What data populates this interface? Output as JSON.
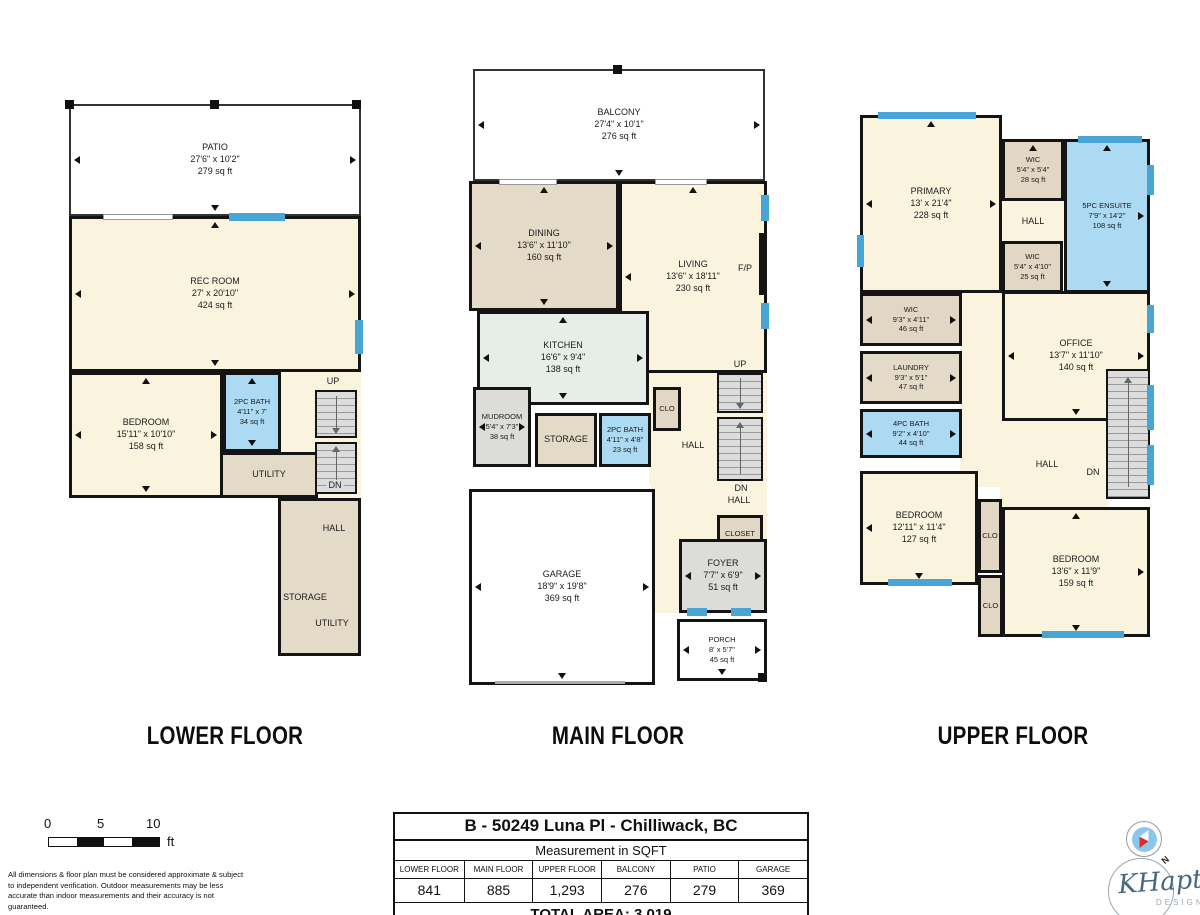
{
  "colors": {
    "wall": "#141414",
    "window_blue": "#49A5D6",
    "room_cream": "#FAF3DE",
    "room_tan": "#E4DAC8",
    "room_bath_blue": "#ABDAF2",
    "room_kitchen": "#E6EEE7",
    "room_gray": "#DCDDD9",
    "stairs_gray": "#DCDCDC",
    "compass_blue": "#8CC6EA",
    "compass_red": "#D93025",
    "logo_blue": "#47687F"
  },
  "floors": [
    {
      "label": "LOWER FLOOR",
      "rooms": [
        {
          "name": "PATIO",
          "dims": "27'6\" x 10'2\"",
          "sqft": "279 sq ft"
        },
        {
          "name": "REC ROOM",
          "dims": "27' x 20'10\"",
          "sqft": "424 sq ft"
        },
        {
          "name": "BEDROOM",
          "dims": "15'11\" x 10'10\"",
          "sqft": "158 sq ft"
        },
        {
          "name": "2PC BATH",
          "dims": "4'11\" x 7'",
          "sqft": "34 sq ft"
        },
        {
          "name": "UTILITY"
        },
        {
          "name": "UP"
        },
        {
          "name": "DN"
        },
        {
          "name": "HALL"
        },
        {
          "name": "STORAGE"
        },
        {
          "name": "UTILITY"
        }
      ]
    },
    {
      "label": "MAIN FLOOR",
      "rooms": [
        {
          "name": "BALCONY",
          "dims": "27'4\" x 10'1\"",
          "sqft": "276 sq ft"
        },
        {
          "name": "DINING",
          "dims": "13'6\" x 11'10\"",
          "sqft": "160 sq ft"
        },
        {
          "name": "LIVING",
          "dims": "13'6\" x 18'11\"",
          "sqft": "230 sq ft"
        },
        {
          "name": "F/P"
        },
        {
          "name": "KITCHEN",
          "dims": "16'6\" x 9'4\"",
          "sqft": "138 sq ft"
        },
        {
          "name": "MUDROOM",
          "dims": "5'4\" x 7'3\"",
          "sqft": "38 sq ft"
        },
        {
          "name": "STORAGE"
        },
        {
          "name": "2PC BATH",
          "dims": "4'11\" x 4'8\"",
          "sqft": "23 sq ft"
        },
        {
          "name": "CLO"
        },
        {
          "name": "HALL"
        },
        {
          "name": "UP"
        },
        {
          "name": "DN"
        },
        {
          "name": "HALL"
        },
        {
          "name": "CLOSET"
        },
        {
          "name": "GARAGE",
          "dims": "18'9\" x 19'8\"",
          "sqft": "369 sq ft"
        },
        {
          "name": "FOYER",
          "dims": "7'7\" x 6'9\"",
          "sqft": "51 sq ft"
        },
        {
          "name": "PORCH",
          "dims": "8' x 5'7\"",
          "sqft": "45 sq ft"
        }
      ]
    },
    {
      "label": "UPPER FLOOR",
      "rooms": [
        {
          "name": "PRIMARY",
          "dims": "13' x 21'4\"",
          "sqft": "228 sq ft"
        },
        {
          "name": "WIC",
          "dims": "5'4\" x 5'4\"",
          "sqft": "28 sq ft"
        },
        {
          "name": "5PC ENSUITE",
          "dims": "7'9\" x 14'2\"",
          "sqft": "108 sq ft"
        },
        {
          "name": "HALL"
        },
        {
          "name": "WIC",
          "dims": "5'4\" x 4'10\"",
          "sqft": "25 sq ft"
        },
        {
          "name": "WIC",
          "dims": "9'3\" x 4'11\"",
          "sqft": "46 sq ft"
        },
        {
          "name": "LAUNDRY",
          "dims": "9'3\" x 5'1\"",
          "sqft": "47 sq ft"
        },
        {
          "name": "4PC BATH",
          "dims": "9'2\" x 4'10\"",
          "sqft": "44 sq ft"
        },
        {
          "name": "OFFICE",
          "dims": "13'7\" x 11'10\"",
          "sqft": "140 sq ft"
        },
        {
          "name": "HALL"
        },
        {
          "name": "DN"
        },
        {
          "name": "BEDROOM",
          "dims": "12'11\" x 11'4\"",
          "sqft": "127 sq ft"
        },
        {
          "name": "CLO"
        },
        {
          "name": "BEDROOM",
          "dims": "13'6\" x 11'9\"",
          "sqft": "159 sq ft"
        },
        {
          "name": "CLO"
        }
      ]
    }
  ],
  "table": {
    "title": "B - 50249 Luna Pl - Chilliwack, BC",
    "subtitle": "Measurement in SQFT",
    "columns": [
      "LOWER FLOOR",
      "MAIN FLOOR",
      "UPPER FLOOR",
      "BALCONY",
      "PATIO",
      "GARAGE"
    ],
    "values": [
      "841",
      "885",
      "1,293",
      "276",
      "279",
      "369"
    ],
    "total": "TOTAL AREA: 3,019"
  },
  "footer": {
    "scale": {
      "t0": "0",
      "t5": "5",
      "t10": "10",
      "unit": "ft"
    },
    "disclaimer": "All dimensions & floor plan must be considered approximate & subject to independent verification.  Outdoor measurements may be less accurate than indoor measurements and their accuracy is not guaranteed.",
    "compass_n": "N",
    "brand": "KHaptive",
    "brand_sub": "DESIGN"
  }
}
